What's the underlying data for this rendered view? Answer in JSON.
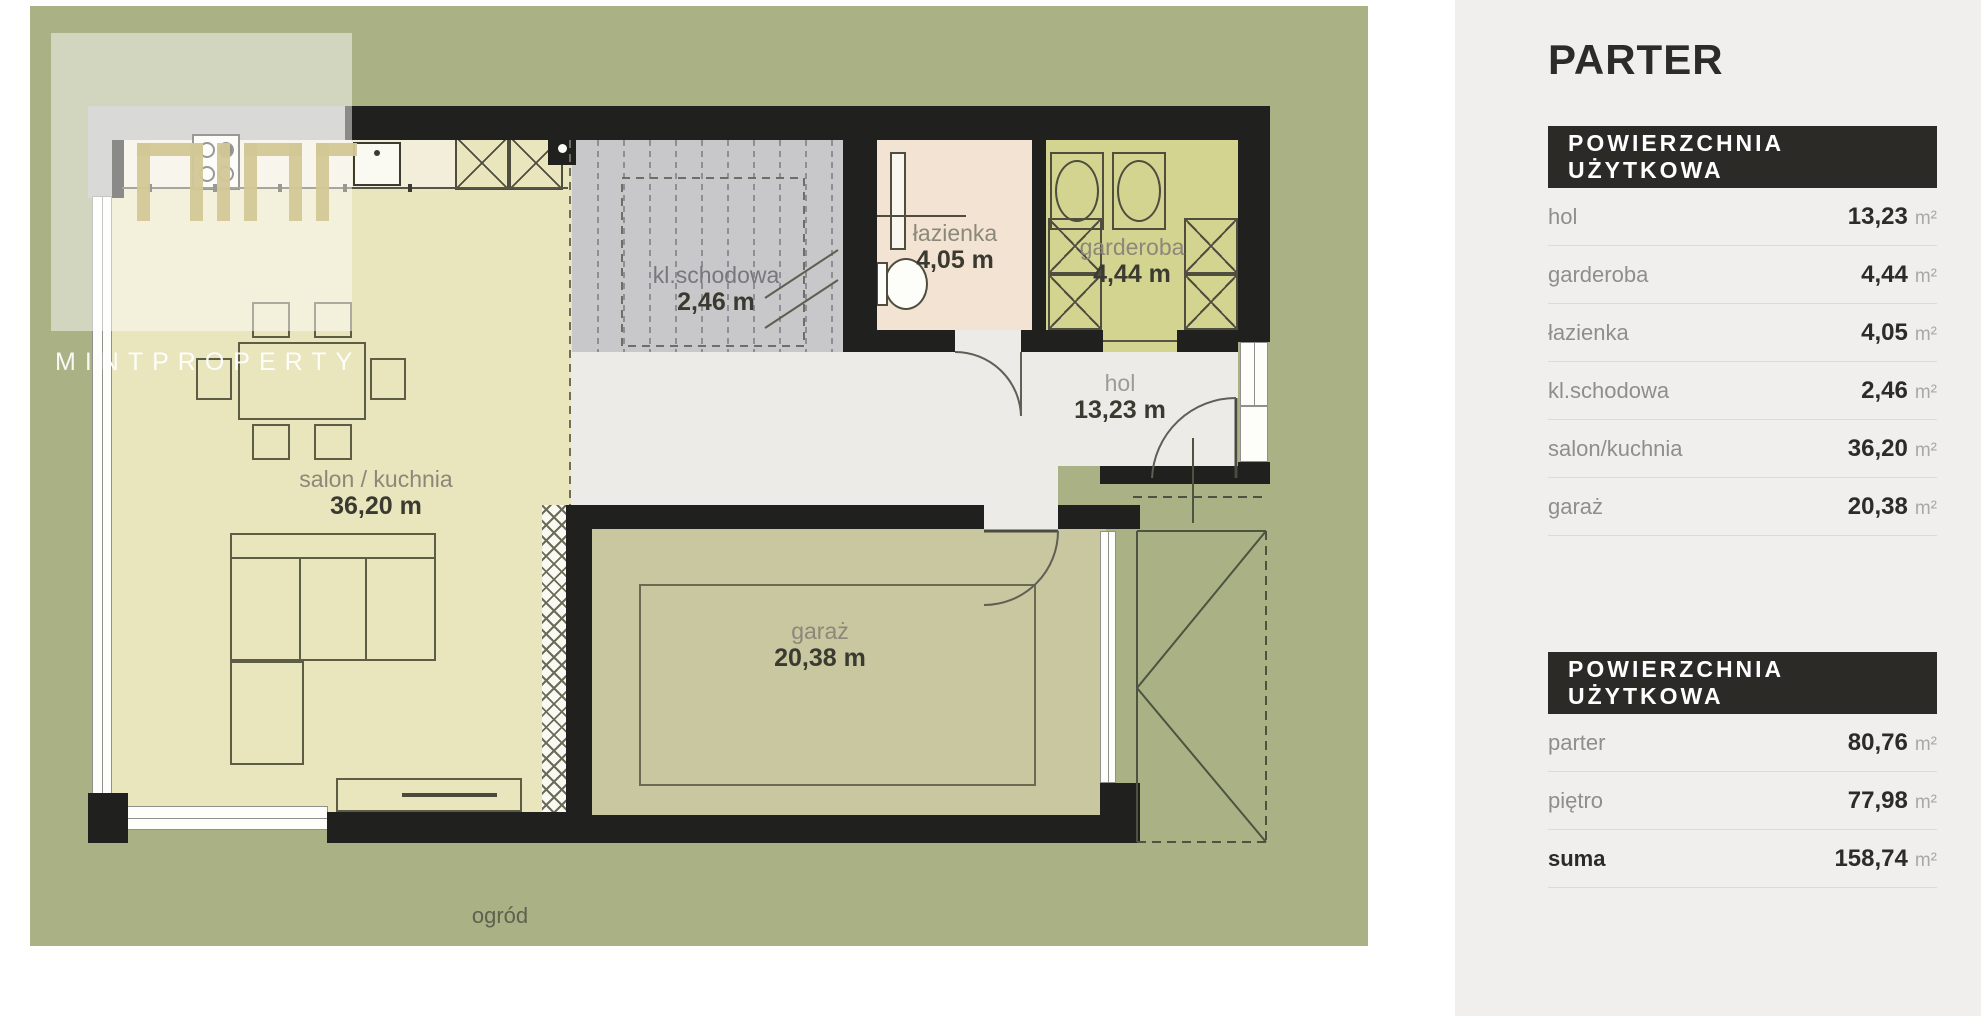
{
  "watermark": {
    "brand": "MINTPROPERTY"
  },
  "plan": {
    "garden_label": "ogród",
    "rooms": [
      {
        "name": "salon / kuchnia",
        "area": "36,20 m"
      },
      {
        "name": "kl.schodowa",
        "area": "2,46 m"
      },
      {
        "name": "łazienka",
        "area": "4,05 m"
      },
      {
        "name": "garderoba",
        "area": "4,44 m"
      },
      {
        "name": "hol",
        "area": "13,23 m"
      },
      {
        "name": "garaż",
        "area": "20,38 m"
      }
    ],
    "colors": {
      "garden": "#a9b185",
      "salon": "#e9e5bd",
      "stairs": "#c8c8ca",
      "bathroom": "#f3e3d2",
      "wardrobe": "#d4d491",
      "hall": "#ecebe8",
      "garage": "#c8c7a0",
      "wall": "#20201e"
    }
  },
  "panel": {
    "title": "PARTER",
    "unit": "m²",
    "tables": [
      {
        "header": "POWIERZCHNIA UŻYTKOWA",
        "rows": [
          {
            "label": "hol",
            "value": "13,23"
          },
          {
            "label": "garderoba",
            "value": "4,44"
          },
          {
            "label": "łazienka",
            "value": "4,05"
          },
          {
            "label": "kl.schodowa",
            "value": "2,46"
          },
          {
            "label": "salon/kuchnia",
            "value": "36,20"
          },
          {
            "label": "garaż",
            "value": "20,38"
          }
        ]
      },
      {
        "header": "POWIERZCHNIA UŻYTKOWA",
        "rows": [
          {
            "label": "parter",
            "value": "80,76"
          },
          {
            "label": "piętro",
            "value": "77,98"
          },
          {
            "label": "suma",
            "value": "158,74"
          }
        ]
      }
    ]
  }
}
